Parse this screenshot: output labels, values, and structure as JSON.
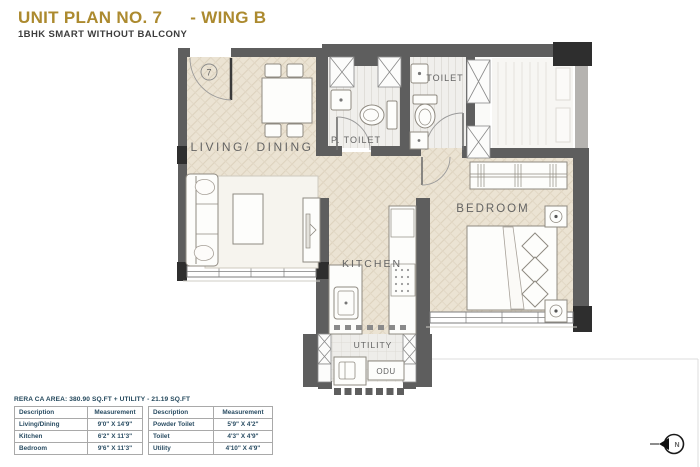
{
  "header": {
    "title": "UNIT PLAN NO. 7",
    "wing": "- WING B",
    "subtitle": "1BHK SMART WITHOUT BALCONY"
  },
  "plan": {
    "unit_number": "7",
    "labels": {
      "living_dining": "LIVING/ DINING",
      "p_toilet": "P. TOILET",
      "toilet": "TOILET",
      "kitchen": "KITCHEN",
      "bedroom": "BEDROOM",
      "utility": "UTILITY",
      "odu": "ODU"
    },
    "compass_north": "N"
  },
  "area_summary": "RERA CA AREA: 380.90 SQ.FT + UTILITY - 21.19 SQ.FT",
  "measurement_table": {
    "left": {
      "col_description": "Description",
      "col_measurement": "Measurement",
      "rows": [
        {
          "description": "Living/Dining",
          "measurement": "9'0\" X 14'9\""
        },
        {
          "description": "Kitchen",
          "measurement": "6'2\" X 11'3\""
        },
        {
          "description": "Bedroom",
          "measurement": "9'6\" X 11'3\""
        }
      ]
    },
    "right": {
      "col_description": "Description",
      "col_measurement": "Measurement",
      "rows": [
        {
          "description": "Powder Toilet",
          "measurement": "5'9\" X 4'2\""
        },
        {
          "description": "Toilet",
          "measurement": "4'3\" X 4'9\""
        },
        {
          "description": "Utility",
          "measurement": "4'10\" X 4'9\""
        }
      ]
    }
  },
  "colors": {
    "title_gold": "#AC8A2F",
    "wall_gray": "#5E5E5E",
    "wall_dark": "#2E2E2E",
    "floor_beige": "#EBE3D3",
    "table_text": "#2A4D63"
  }
}
